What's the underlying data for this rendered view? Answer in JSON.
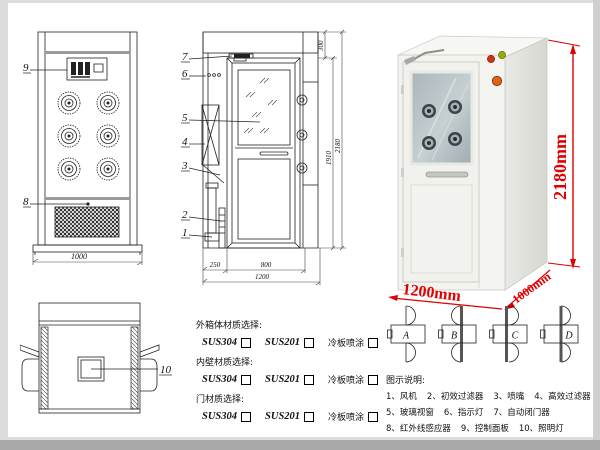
{
  "colors": {
    "dimension_red": "#e00000",
    "line": "#222222"
  },
  "front_view": {
    "callout_panel": "9",
    "callout_grille": "8",
    "dim_width": "1000"
  },
  "side_view": {
    "callouts": [
      "7",
      "6",
      "5",
      "4",
      "3",
      "2",
      "1"
    ],
    "dims": {
      "top": "300",
      "door_height": "1910",
      "total_height": "2180",
      "entry_depth": "250",
      "door_width": "800",
      "total_width": "1200"
    }
  },
  "top_view": {
    "callout_light": "10"
  },
  "photo": {
    "dims": {
      "height": "2180mm",
      "width": "1200mm",
      "depth": "1000mm"
    }
  },
  "materials": {
    "groups": [
      {
        "title": "外箱体材质选择:",
        "options": [
          "SUS304",
          "SUS201",
          "冷板喷涂"
        ]
      },
      {
        "title": "内壁材质选择:",
        "options": [
          "SUS304",
          "SUS201",
          "冷板喷涂"
        ]
      },
      {
        "title": "门材质选择:",
        "options": [
          "SUS304",
          "SUS201",
          "冷板喷涂"
        ]
      }
    ]
  },
  "door_configs": {
    "labels": [
      "A",
      "B",
      "C",
      "D"
    ]
  },
  "legend": {
    "title": "图示说明:",
    "items": [
      "1、风机",
      "2、初效过滤器",
      "3、喷嘴",
      "4、高效过滤器",
      "5、玻璃视窗",
      "6、指示灯",
      "7、自动闭门器",
      "8、红外线感应器",
      "9、控制面板",
      "10、照明灯"
    ]
  }
}
